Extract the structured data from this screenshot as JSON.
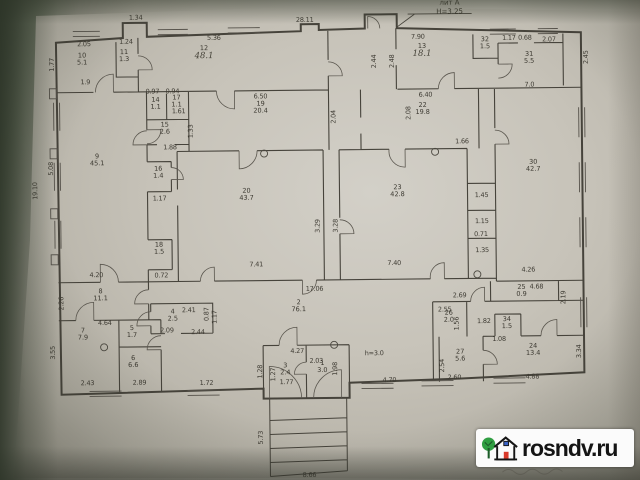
{
  "watermark": {
    "site": "rosndv.ru"
  },
  "colors": {
    "paper": "#cbc7bd",
    "background": "#414a3c",
    "ink": "#46433b",
    "watermark_bg": "#fbfbfb",
    "watermark_text": "#141414",
    "logo_green": "#2f9e41",
    "logo_red": "#d93a2b",
    "logo_blue": "#3a63c6"
  },
  "plan": {
    "annotation": {
      "liter": "лит А",
      "height": "Н=3.25"
    },
    "rooms": [
      {
        "n": "10",
        "a": "5.1",
        "x": 84,
        "y": 57
      },
      {
        "n": "11",
        "a": "1.3",
        "x": 126,
        "y": 54
      },
      {
        "n": "12",
        "a": "48.1",
        "x": 206,
        "y": 52,
        "hand": true
      },
      {
        "n": "13",
        "a": "18.1",
        "x": 424,
        "y": 52,
        "hand": true
      },
      {
        "n": "32",
        "a": "1.5",
        "x": 487,
        "y": 45
      },
      {
        "n": "31",
        "a": "5.5",
        "x": 531,
        "y": 60
      },
      {
        "n": "14",
        "a": "1.1",
        "x": 157,
        "y": 102
      },
      {
        "n": "17",
        "a": "1.1",
        "x": 178,
        "y": 100
      },
      {
        "n": "15",
        "a": "2.6",
        "x": 166,
        "y": 127
      },
      {
        "n": "19",
        "a": "20.4",
        "x": 262,
        "y": 107
      },
      {
        "n": "22",
        "a": "19.8",
        "x": 424,
        "y": 110
      },
      {
        "n": "16",
        "a": "1.4",
        "x": 159,
        "y": 171
      },
      {
        "n": "9",
        "a": "45.1",
        "x": 98,
        "y": 158
      },
      {
        "n": "20",
        "a": "43.7",
        "x": 247,
        "y": 194
      },
      {
        "n": "23",
        "a": "42.8",
        "x": 398,
        "y": 192
      },
      {
        "n": "30",
        "a": "42.7",
        "x": 534,
        "y": 168
      },
      {
        "n": "18",
        "a": "1.5",
        "x": 159,
        "y": 247
      },
      {
        "n": "8",
        "a": "11.1",
        "x": 100,
        "y": 293
      },
      {
        "n": "7",
        "a": "7.9",
        "x": 82,
        "y": 332
      },
      {
        "n": "4",
        "a": "2.5",
        "x": 172,
        "y": 314
      },
      {
        "n": "5",
        "a": "1.7",
        "x": 131,
        "y": 330
      },
      {
        "n": "6",
        "a": "6.6",
        "x": 132,
        "y": 360
      },
      {
        "n": "2",
        "a": "76.1",
        "x": 298,
        "y": 306
      },
      {
        "n": "3",
        "a": "2.4",
        "x": 284,
        "y": 369
      },
      {
        "n": "1",
        "a": "3.0",
        "x": 321,
        "y": 367
      },
      {
        "n": "25",
        "a": "0.9",
        "x": 521,
        "y": 293
      },
      {
        "n": "26",
        "a": "2.0",
        "x": 448,
        "y": 318
      },
      {
        "n": "34",
        "a": "1.5",
        "x": 506,
        "y": 325
      },
      {
        "n": "27",
        "a": "5.6",
        "x": 459,
        "y": 357
      },
      {
        "n": "24",
        "a": "13.4",
        "x": 532,
        "y": 352
      }
    ],
    "dimensions": [
      {
        "t": "28.11",
        "x": 307,
        "y": 20
      },
      {
        "t": "1.34",
        "x": 138,
        "y": 16
      },
      {
        "t": "2.05",
        "x": 86,
        "y": 42
      },
      {
        "t": "1.24",
        "x": 128,
        "y": 40
      },
      {
        "t": "1.77",
        "x": 54,
        "y": 62,
        "r": 1
      },
      {
        "t": "1.9",
        "x": 87,
        "y": 80
      },
      {
        "t": "5.36",
        "x": 216,
        "y": 37
      },
      {
        "t": "7.90",
        "x": 420,
        "y": 38
      },
      {
        "t": "2.44",
        "x": 376,
        "y": 62,
        "r": 1
      },
      {
        "t": "2.48",
        "x": 394,
        "y": 62,
        "r": 1
      },
      {
        "t": "1.17",
        "x": 511,
        "y": 40
      },
      {
        "t": "0.68",
        "x": 527,
        "y": 40
      },
      {
        "t": "2.07",
        "x": 551,
        "y": 42
      },
      {
        "t": "2.45",
        "x": 588,
        "y": 60,
        "r": 1
      },
      {
        "t": "7.0",
        "x": 531,
        "y": 87
      },
      {
        "t": "6.50",
        "x": 262,
        "y": 96
      },
      {
        "t": "6.40",
        "x": 427,
        "y": 96
      },
      {
        "t": "2.04",
        "x": 335,
        "y": 117,
        "r": 1
      },
      {
        "t": "2.08",
        "x": 410,
        "y": 114,
        "r": 1
      },
      {
        "t": "0.97",
        "x": 154,
        "y": 90
      },
      {
        "t": "0.94",
        "x": 174,
        "y": 90
      },
      {
        "t": "1.61",
        "x": 180,
        "y": 110
      },
      {
        "t": "1.33",
        "x": 192,
        "y": 130,
        "r": 1
      },
      {
        "t": "1.88",
        "x": 171,
        "y": 146
      },
      {
        "t": "1.66",
        "x": 463,
        "y": 143
      },
      {
        "t": "19.10",
        "x": 36,
        "y": 188,
        "r": 1
      },
      {
        "t": "5.08",
        "x": 52,
        "y": 166,
        "r": 1
      },
      {
        "t": "1.17",
        "x": 160,
        "y": 197
      },
      {
        "t": "3.29",
        "x": 318,
        "y": 226,
        "r": 1
      },
      {
        "t": "3.28",
        "x": 336,
        "y": 226,
        "r": 1
      },
      {
        "t": "1.45",
        "x": 482,
        "y": 197
      },
      {
        "t": "1.15",
        "x": 482,
        "y": 223
      },
      {
        "t": "0.71",
        "x": 481,
        "y": 236
      },
      {
        "t": "1.35",
        "x": 482,
        "y": 252
      },
      {
        "t": "4.20",
        "x": 96,
        "y": 273
      },
      {
        "t": "0.72",
        "x": 161,
        "y": 274
      },
      {
        "t": "7.41",
        "x": 256,
        "y": 264
      },
      {
        "t": "7.40",
        "x": 394,
        "y": 264
      },
      {
        "t": "4.26",
        "x": 528,
        "y": 272
      },
      {
        "t": "17.06",
        "x": 314,
        "y": 289
      },
      {
        "t": "4.68",
        "x": 536,
        "y": 289
      },
      {
        "t": "2.69",
        "x": 459,
        "y": 297
      },
      {
        "t": "2.19",
        "x": 563,
        "y": 300,
        "r": 1
      },
      {
        "t": "2.26",
        "x": 61,
        "y": 301,
        "r": 1
      },
      {
        "t": "4.64",
        "x": 104,
        "y": 321
      },
      {
        "t": "2.09",
        "x": 166,
        "y": 329
      },
      {
        "t": "2.41",
        "x": 188,
        "y": 309
      },
      {
        "t": "0.87",
        "x": 206,
        "y": 313,
        "r": 1
      },
      {
        "t": "1.17",
        "x": 214,
        "y": 316,
        "r": 1
      },
      {
        "t": "2.44",
        "x": 197,
        "y": 331
      },
      {
        "t": "3.55",
        "x": 52,
        "y": 350,
        "r": 1
      },
      {
        "t": "2.43",
        "x": 86,
        "y": 381
      },
      {
        "t": "2.89",
        "x": 138,
        "y": 381
      },
      {
        "t": "1.72",
        "x": 205,
        "y": 382
      },
      {
        "t": "4.27",
        "x": 296,
        "y": 351
      },
      {
        "t": "2.03",
        "x": 315,
        "y": 361
      },
      {
        "t": "1.28",
        "x": 259,
        "y": 371,
        "r": 1
      },
      {
        "t": "1.27",
        "x": 272,
        "y": 374,
        "r": 1
      },
      {
        "t": "1.77",
        "x": 285,
        "y": 382
      },
      {
        "t": "1.98",
        "x": 334,
        "y": 369,
        "r": 1
      },
      {
        "t": "h=3.0",
        "x": 373,
        "y": 354
      },
      {
        "t": "4.70",
        "x": 388,
        "y": 381
      },
      {
        "t": "2.55",
        "x": 444,
        "y": 311
      },
      {
        "t": "1.56",
        "x": 456,
        "y": 325,
        "r": 1
      },
      {
        "t": "1.82",
        "x": 483,
        "y": 323
      },
      {
        "t": "1.08",
        "x": 498,
        "y": 341
      },
      {
        "t": "2.54",
        "x": 441,
        "y": 367,
        "r": 1
      },
      {
        "t": "2.60",
        "x": 453,
        "y": 379
      },
      {
        "t": "4.88",
        "x": 531,
        "y": 379
      },
      {
        "t": "3.34",
        "x": 578,
        "y": 354,
        "r": 1
      },
      {
        "t": "5.73",
        "x": 259,
        "y": 437,
        "r": 1
      },
      {
        "t": "8.66",
        "x": 307,
        "y": 475
      }
    ]
  }
}
